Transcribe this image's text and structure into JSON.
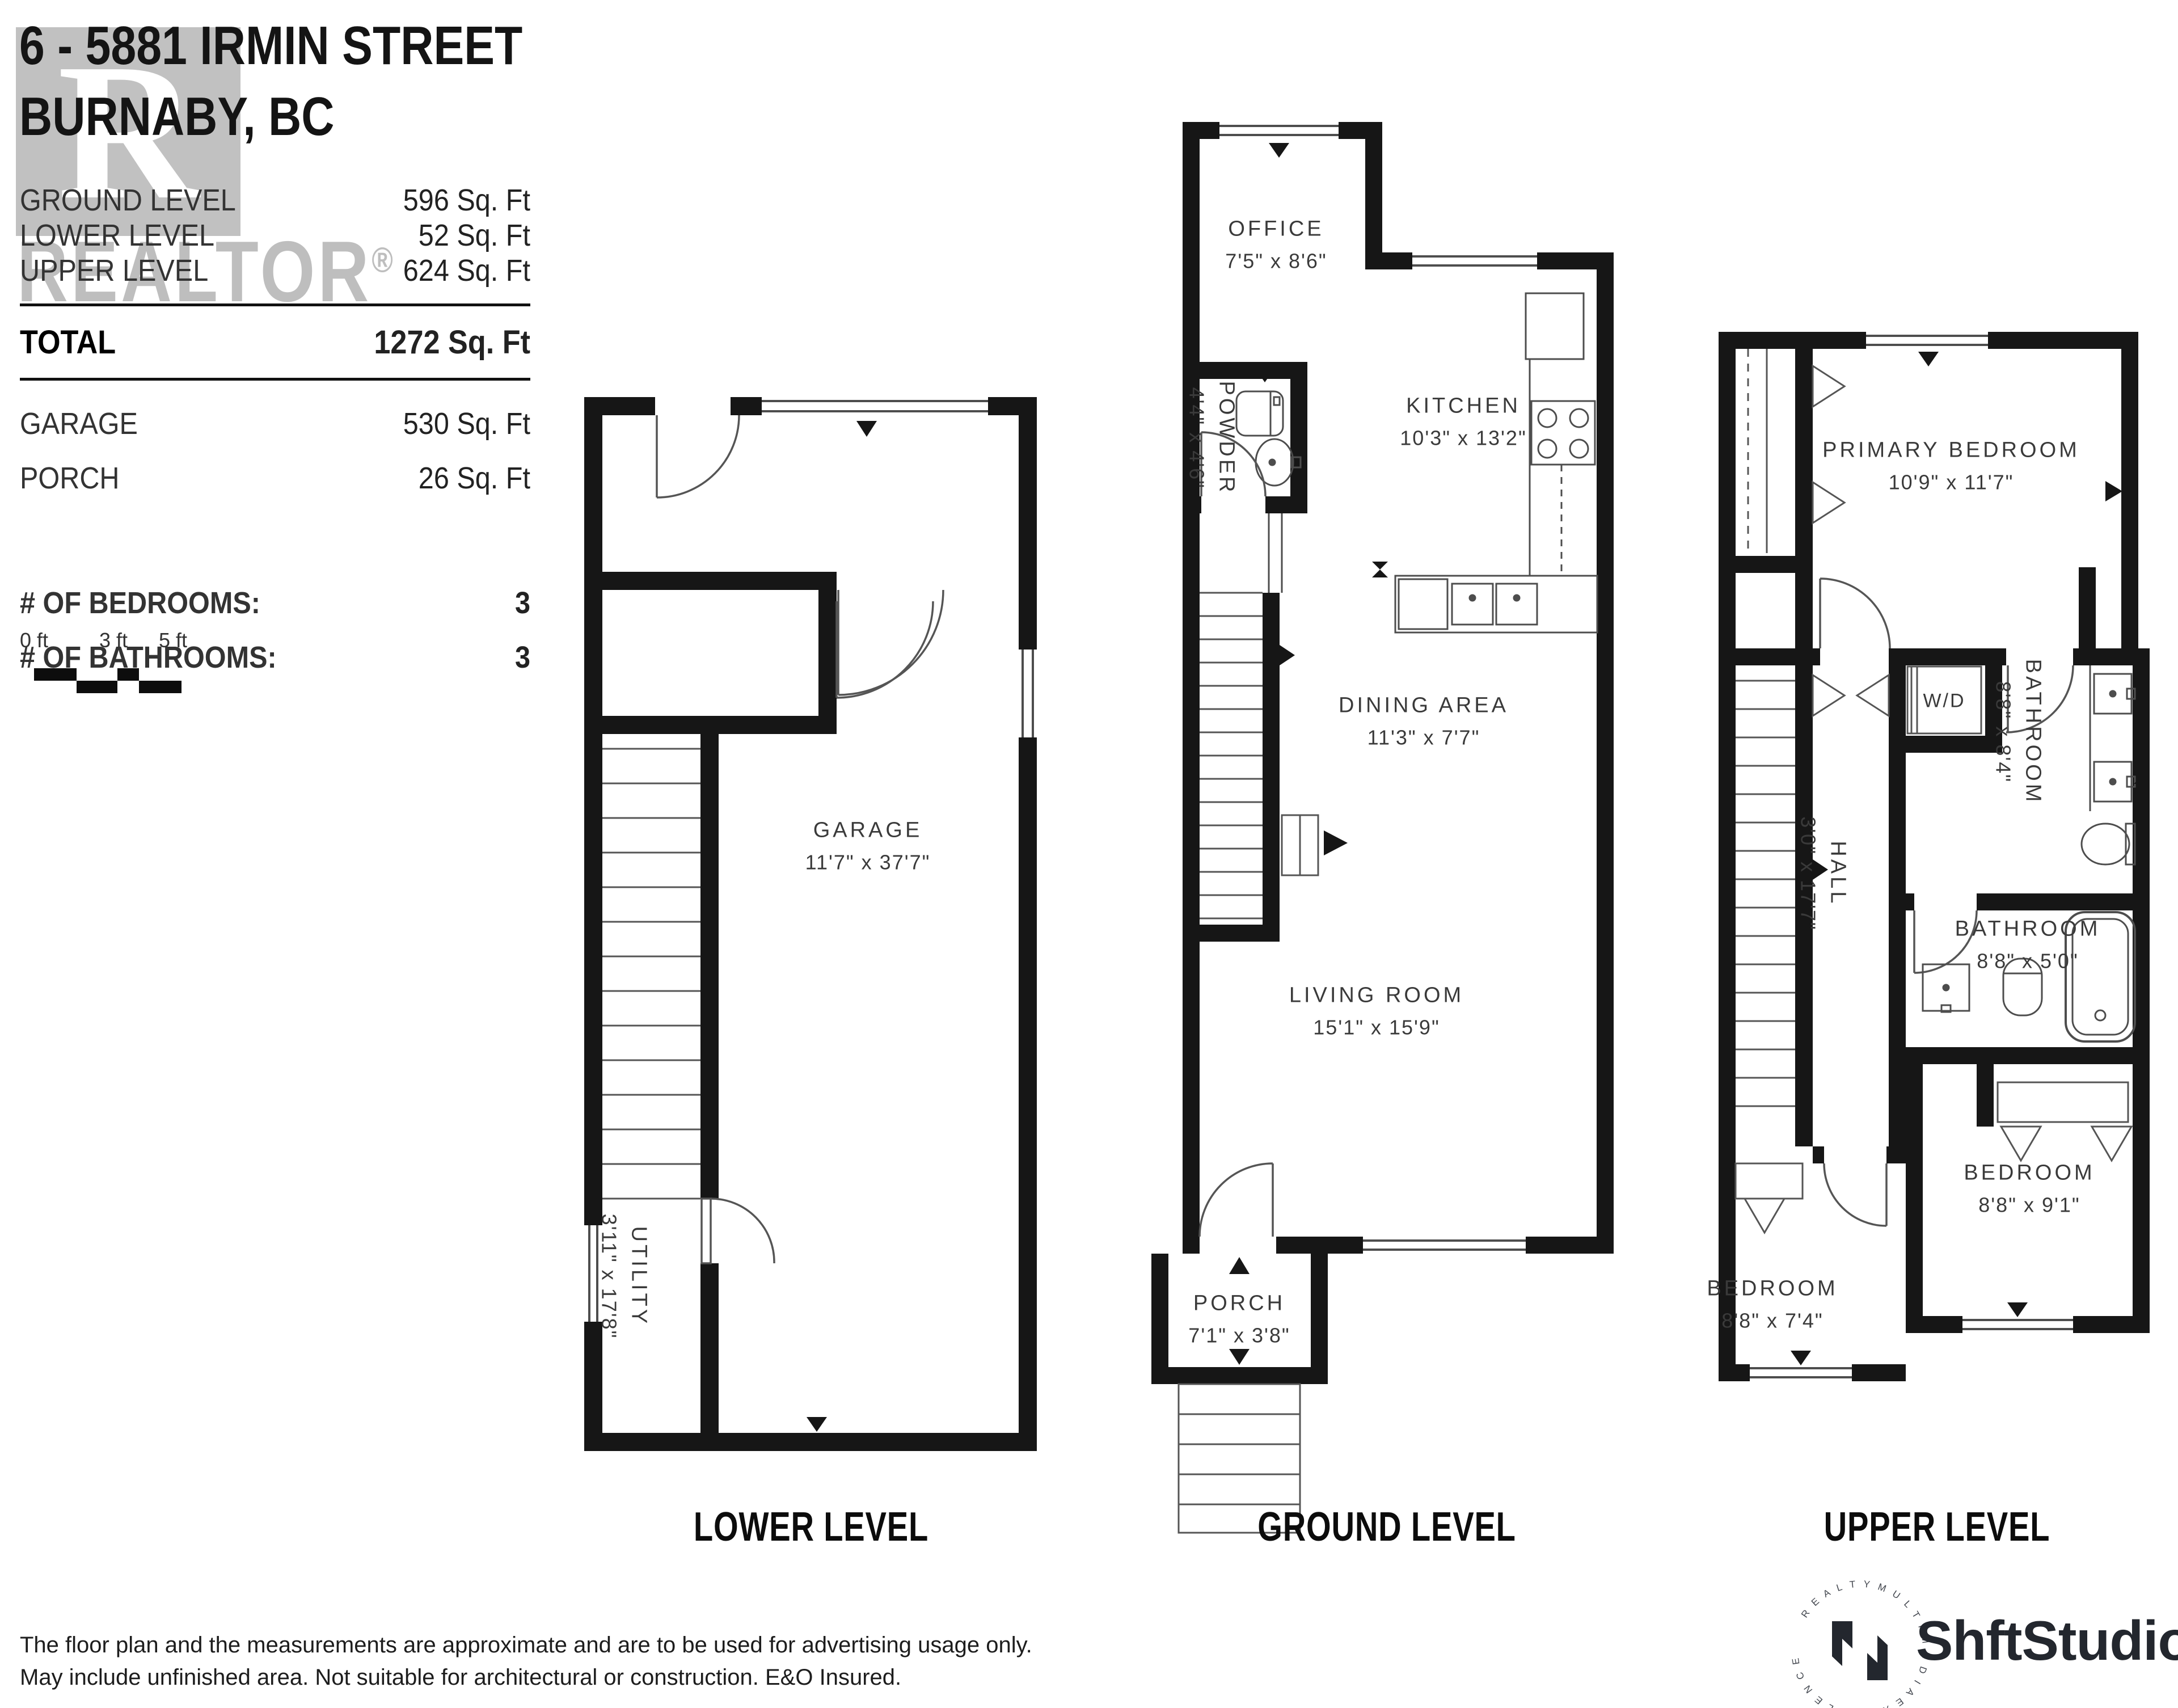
{
  "header": {
    "address_line1": "6 - 5881 IRMIN STREET",
    "address_line2": "BURNABY, BC"
  },
  "summary": {
    "area_rows": [
      {
        "label": "GROUND LEVEL",
        "value": "596 Sq. Ft"
      },
      {
        "label": "LOWER LEVEL",
        "value": "52 Sq. Ft"
      },
      {
        "label": "UPPER LEVEL",
        "value": "624 Sq. Ft"
      }
    ],
    "total": {
      "label": "TOTAL",
      "value": "1272 Sq. Ft"
    },
    "extra_rows": [
      {
        "label": "GARAGE",
        "value": "530 Sq. Ft"
      },
      {
        "label": "PORCH",
        "value": "26 Sq. Ft"
      }
    ],
    "count_rows": [
      {
        "label": "# OF BEDROOMS:",
        "value": "3"
      },
      {
        "label": "# OF BATHROOMS:",
        "value": "3"
      }
    ]
  },
  "scale_bar": {
    "labels": [
      "0 ft",
      "3 ft",
      "5 ft"
    ]
  },
  "watermark": {
    "letter": "R",
    "word": "REALTOR"
  },
  "levels": {
    "lower": {
      "title": "LOWER LEVEL",
      "rooms": {
        "garage": {
          "name": "GARAGE",
          "dims": "11'7\" x 37'7\""
        },
        "utility": {
          "name": "UTILITY",
          "dims": "3'11\" x 17'8\""
        }
      }
    },
    "ground": {
      "title": "GROUND LEVEL",
      "rooms": {
        "office": {
          "name": "OFFICE",
          "dims": "7'5\" x 8'6\""
        },
        "powder": {
          "name": "POWDER",
          "dims": "4'4\" x 4'6\""
        },
        "kitchen": {
          "name": "KITCHEN",
          "dims": "10'3\" x 13'2\""
        },
        "dining": {
          "name": "DINING AREA",
          "dims": "11'3\" x 7'7\""
        },
        "living": {
          "name": "LIVING ROOM",
          "dims": "15'1\" x 15'9\""
        },
        "porch": {
          "name": "PORCH",
          "dims": "7'1\" x 3'8\""
        }
      }
    },
    "upper": {
      "title": "UPPER LEVEL",
      "rooms": {
        "primary": {
          "name": "PRIMARY BEDROOM",
          "dims": "10'9\" x 11'7\""
        },
        "wd": {
          "name": "W/D"
        },
        "ensuite": {
          "name": "BATHROOM",
          "dims": "8'8\" x 8'4\""
        },
        "hall": {
          "name": "HALL",
          "dims": "3'0\" x 17'7\""
        },
        "bath": {
          "name": "BATHROOM",
          "dims": "8'8\" x 5'0\""
        },
        "bedroom2": {
          "name": "BEDROOM",
          "dims": "8'8\" x 9'1\""
        },
        "bedroom3": {
          "name": "BEDROOM",
          "dims": "8'8\" x 7'4\""
        }
      }
    }
  },
  "footer": {
    "disclaimer_line1": "The floor plan and the measurements are approximate and are to be used for advertising usage only.",
    "disclaimer_line2": "May include unfinished area. Not suitable for architectural or construction. E&O Insured.",
    "logo_text": "ShftStudio",
    "logo_ring_text": "R E A L T Y   M U L T I M E D I A   E X C E L L E N C E"
  },
  "colors": {
    "wall": "#161616",
    "line": "#4d4d4d",
    "text": "#3a3a3a"
  }
}
